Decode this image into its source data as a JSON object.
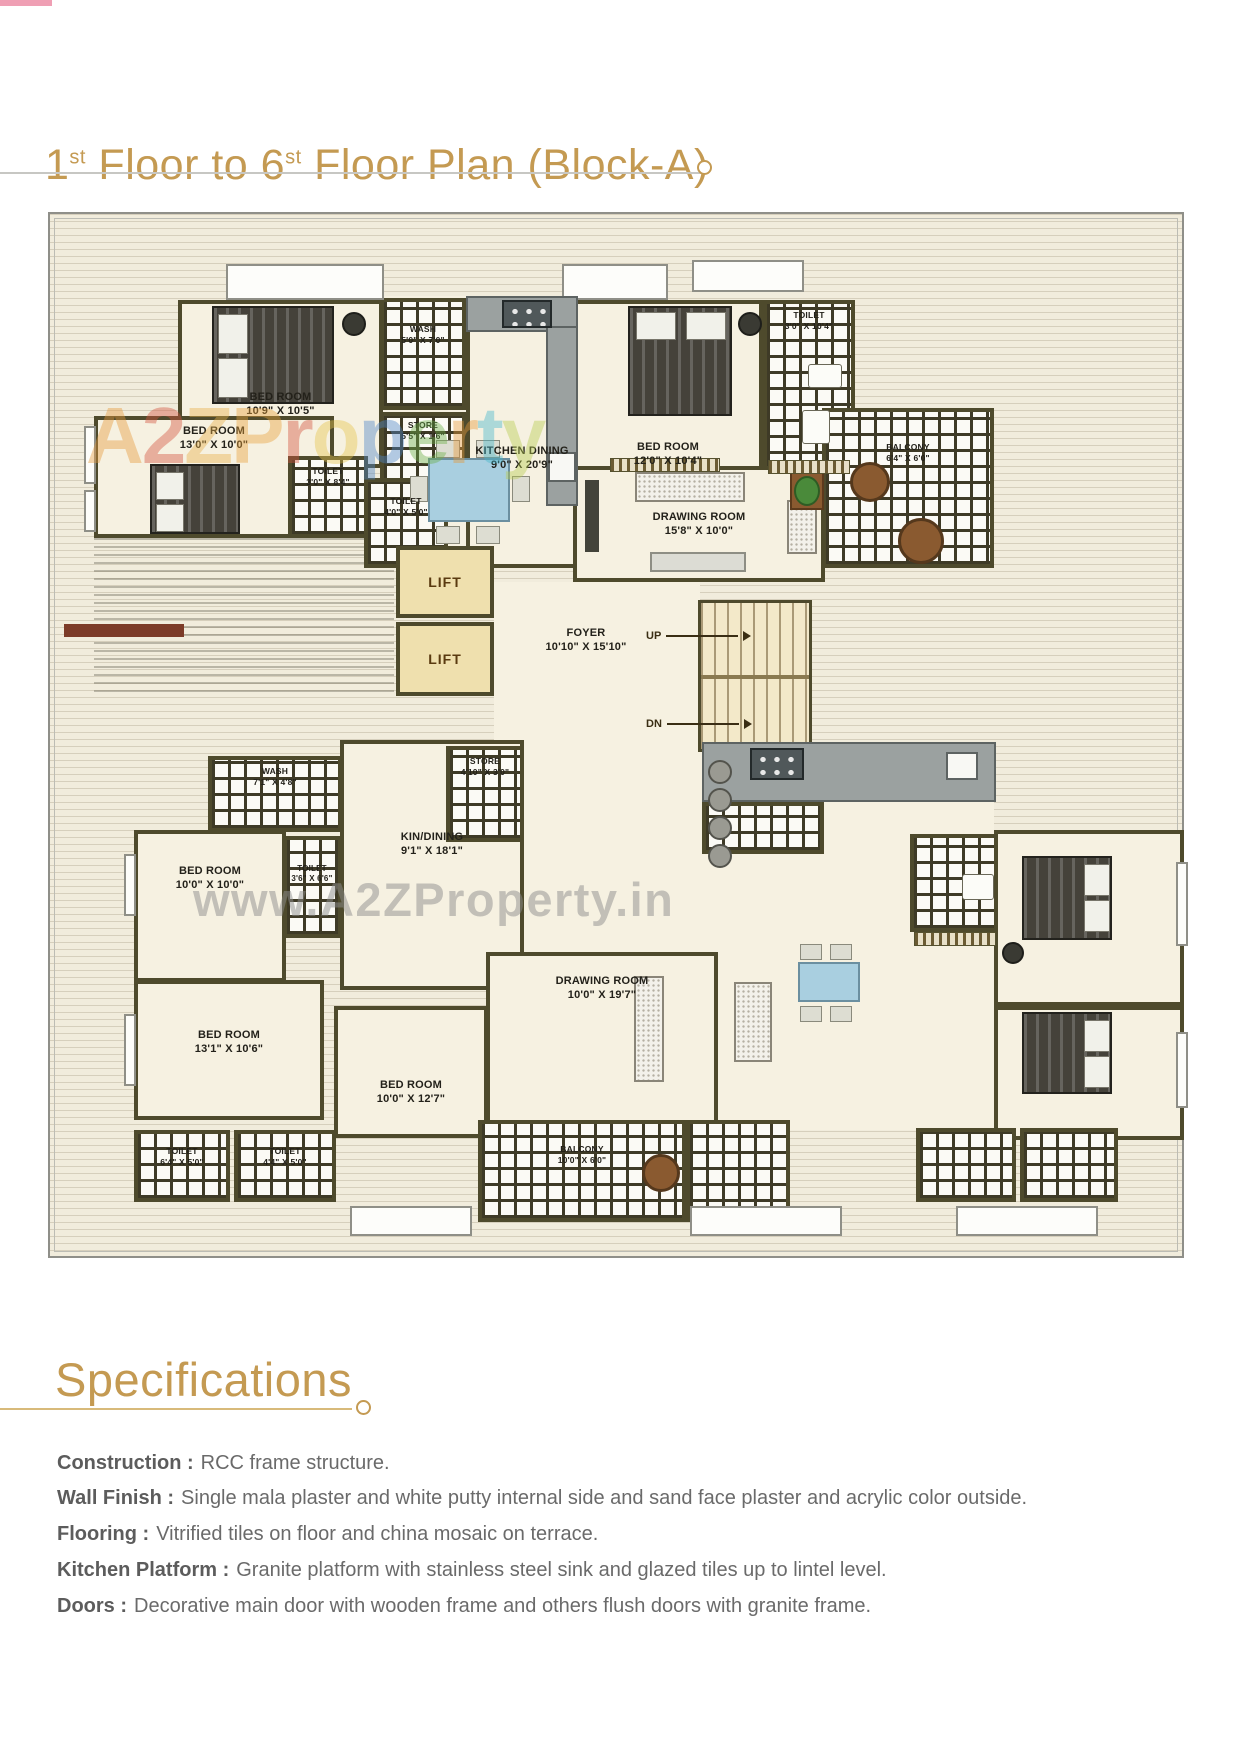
{
  "title": {
    "n1": "1",
    "sup1": "st",
    "mid": " Floor to 6",
    "sup2": "st",
    "rest": " Floor Plan (Block-A)"
  },
  "watermark": {
    "brand_letters": [
      "A",
      "2",
      "Z",
      "P",
      "r",
      "o",
      "p",
      "e",
      "r",
      "t",
      "y"
    ],
    "brand_colors": [
      "#e69a3c",
      "#d4543e",
      "#e8b04a",
      "#e8a23c",
      "#d4543e",
      "#e6c44e",
      "#4e86c8",
      "#6cb04a",
      "#e69a3c",
      "#46b8cc",
      "#b8cc50"
    ],
    "url": "www.A2ZProperty.in"
  },
  "plan": {
    "rooms": {
      "bed1": {
        "name": "BED ROOM",
        "dims": "10'9\" X 10'5\""
      },
      "wash1": {
        "name": "WASH",
        "dims": "5'0\" X 7'0\""
      },
      "store1": {
        "name": "STORE",
        "dims": "5'5\" X 1'6\""
      },
      "kitchen1": {
        "name": "KITCHEN DINING",
        "dims": "9'0\" X 20'9\""
      },
      "bed2": {
        "name": "BED ROOM",
        "dims": "12'0\" X 10'4\""
      },
      "toilet_tr": {
        "name": "TOILET",
        "dims": "3'0\" X 10'4\""
      },
      "drawing1": {
        "name": "DRAWING ROOM",
        "dims": "15'8\" X 10'0\""
      },
      "balcony1": {
        "name": "BALCONY",
        "dims": "6'4\" X 6'0\""
      },
      "bed3": {
        "name": "BED ROOM",
        "dims": "13'0\" X 10'0\""
      },
      "toilet_a": {
        "name": "TOILET",
        "dims": "3'0\" X 8'4\""
      },
      "toilet_b": {
        "name": "TOILET",
        "dims": "4'0\" X 5'0\""
      },
      "lift": {
        "name": "LIFT"
      },
      "foyer": {
        "name": "FOYER",
        "dims": "10'10\" X 15'10\""
      },
      "wash2": {
        "name": "WASH",
        "dims": "7'1\" X 4'8\""
      },
      "store2": {
        "name": "STORE",
        "dims": "4'10\" X 3'0\""
      },
      "kindining": {
        "name": "KIN/DINING",
        "dims": "9'1\" X 18'1\""
      },
      "toilet_c": {
        "name": "TOILET",
        "dims": "3'6\" X 6'6\""
      },
      "bed4": {
        "name": "BED ROOM",
        "dims": "10'0\" X 10'0\""
      },
      "bed5": {
        "name": "BED ROOM",
        "dims": "13'1\" X 10'6\""
      },
      "toilet_d": {
        "name": "TOILET",
        "dims": "6'4\" X 5'0\""
      },
      "toilet_e": {
        "name": "TOILET",
        "dims": "4'4\" X 5'0\""
      },
      "bed6": {
        "name": "BED ROOM",
        "dims": "10'0\" X 12'7\""
      },
      "drawing2": {
        "name": "DRAWING ROOM",
        "dims": "10'0\" X 19'7\""
      },
      "balcony2": {
        "name": "BALCONY",
        "dims": "10'0\" X 6'0\""
      }
    },
    "stairs": {
      "up": "UP",
      "dn": "DN"
    }
  },
  "specs": {
    "heading": "Specifications",
    "items": [
      {
        "label": "Construction :",
        "text": "RCC frame structure."
      },
      {
        "label": "Wall Finish :",
        "text": "Single mala plaster and white putty internal side and sand face plaster and acrylic color outside."
      },
      {
        "label": "Flooring :",
        "text": "Vitrified tiles on floor and china mosaic on terrace."
      },
      {
        "label": "Kitchen Platform :",
        "text": "Granite platform with stainless steel sink and glazed tiles up to lintel level."
      },
      {
        "label": "Doors :",
        "text": "Decorative main door with wooden frame and others flush doors with granite frame."
      }
    ]
  },
  "colors": {
    "accent_gold": "#c49a52",
    "spec_text": "#6a6a6a",
    "wall_olive": "#4e4a2c",
    "plan_background": "#f1ecdc"
  }
}
